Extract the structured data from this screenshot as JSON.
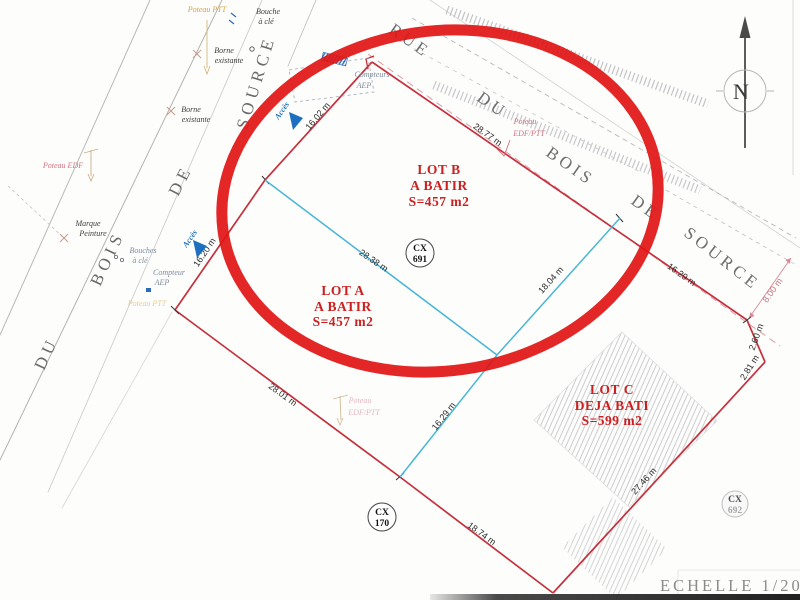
{
  "scale": {
    "label": "ECHELLE 1/200"
  },
  "compass": {
    "n": "N"
  },
  "streets": {
    "left": {
      "w1": "DU",
      "w2": "BOIS",
      "w3": "DE",
      "w4": "SOURCE"
    },
    "top": {
      "w1": "RUE",
      "w2": "DU",
      "w3": "BOIS",
      "w4": "DE",
      "w5": "SOURCE"
    }
  },
  "lots": {
    "b": {
      "name": "LOT B",
      "status": "A BATIR",
      "area": "S=457 m2"
    },
    "a": {
      "name": "LOT A",
      "status": "A BATIR",
      "area": "S=457 m2"
    },
    "c": {
      "name": "LOT C",
      "status": "DEJA BATI",
      "area": "S=599 m2"
    }
  },
  "markers": {
    "cx691": {
      "l1": "CX",
      "l2": "691"
    },
    "cx170": {
      "l1": "CX",
      "l2": "170"
    },
    "cx692": {
      "l1": "CX",
      "l2": "692"
    }
  },
  "dimensions": {
    "lot_b_left": "16.02 m",
    "lot_b_street": "28.77 m",
    "lot_c_street": "16.29 m",
    "lot_a_left": "16.20 m",
    "division_a_b": "28.38 m",
    "division_b_c": "18.04 m",
    "division_a_c": "16.29 m",
    "lot_a_bottom": "28.01 m",
    "lot_c_bottom": "18.74 m",
    "lot_c_right": "27.46 m",
    "corner_upper": "2.60 m",
    "corner_lower": "2.81 m",
    "street_offset": "8.00 m"
  },
  "annotations": {
    "poteau_ptt_top": "Poteau PTT",
    "bouche_a_cle": {
      "l1": "Bouche",
      "l2": "à clé"
    },
    "borne_existante_1": {
      "l1": "Borne",
      "l2": "existante"
    },
    "borne_existante_2": {
      "l1": "Borne",
      "l2": "existante"
    },
    "poteau_edf": "Poteau EDF",
    "marque_peinture": {
      "l1": "Marque",
      "l2": "Peinture"
    },
    "bouches_a_cle": {
      "l1": "Bouches",
      "l2": "à clé"
    },
    "compteur_aep": {
      "l1": "Compteur",
      "l2": "AEP"
    },
    "poteau_ptt_left": "Poteau PTT",
    "acces_top": "Accès",
    "acces_left": "Accès",
    "compteurs_aep": {
      "l1": "Compteurs",
      "l2": "AEP"
    },
    "poteau_edf_ptt_street": {
      "l1": "Poteau",
      "l2": "EDF/PTT"
    },
    "poteau_edf_ptt_mid": {
      "l1": "Poteau",
      "l2": "EDF/PTT"
    }
  },
  "colors": {
    "boundary_red": "#c5303c",
    "marker_red": "#e11414",
    "division_cyan": "#49b6d6",
    "access_blue": "#1d6fc0",
    "dashed_pink": "#e09aa6",
    "lot_label_red": "#cc1f1f"
  }
}
